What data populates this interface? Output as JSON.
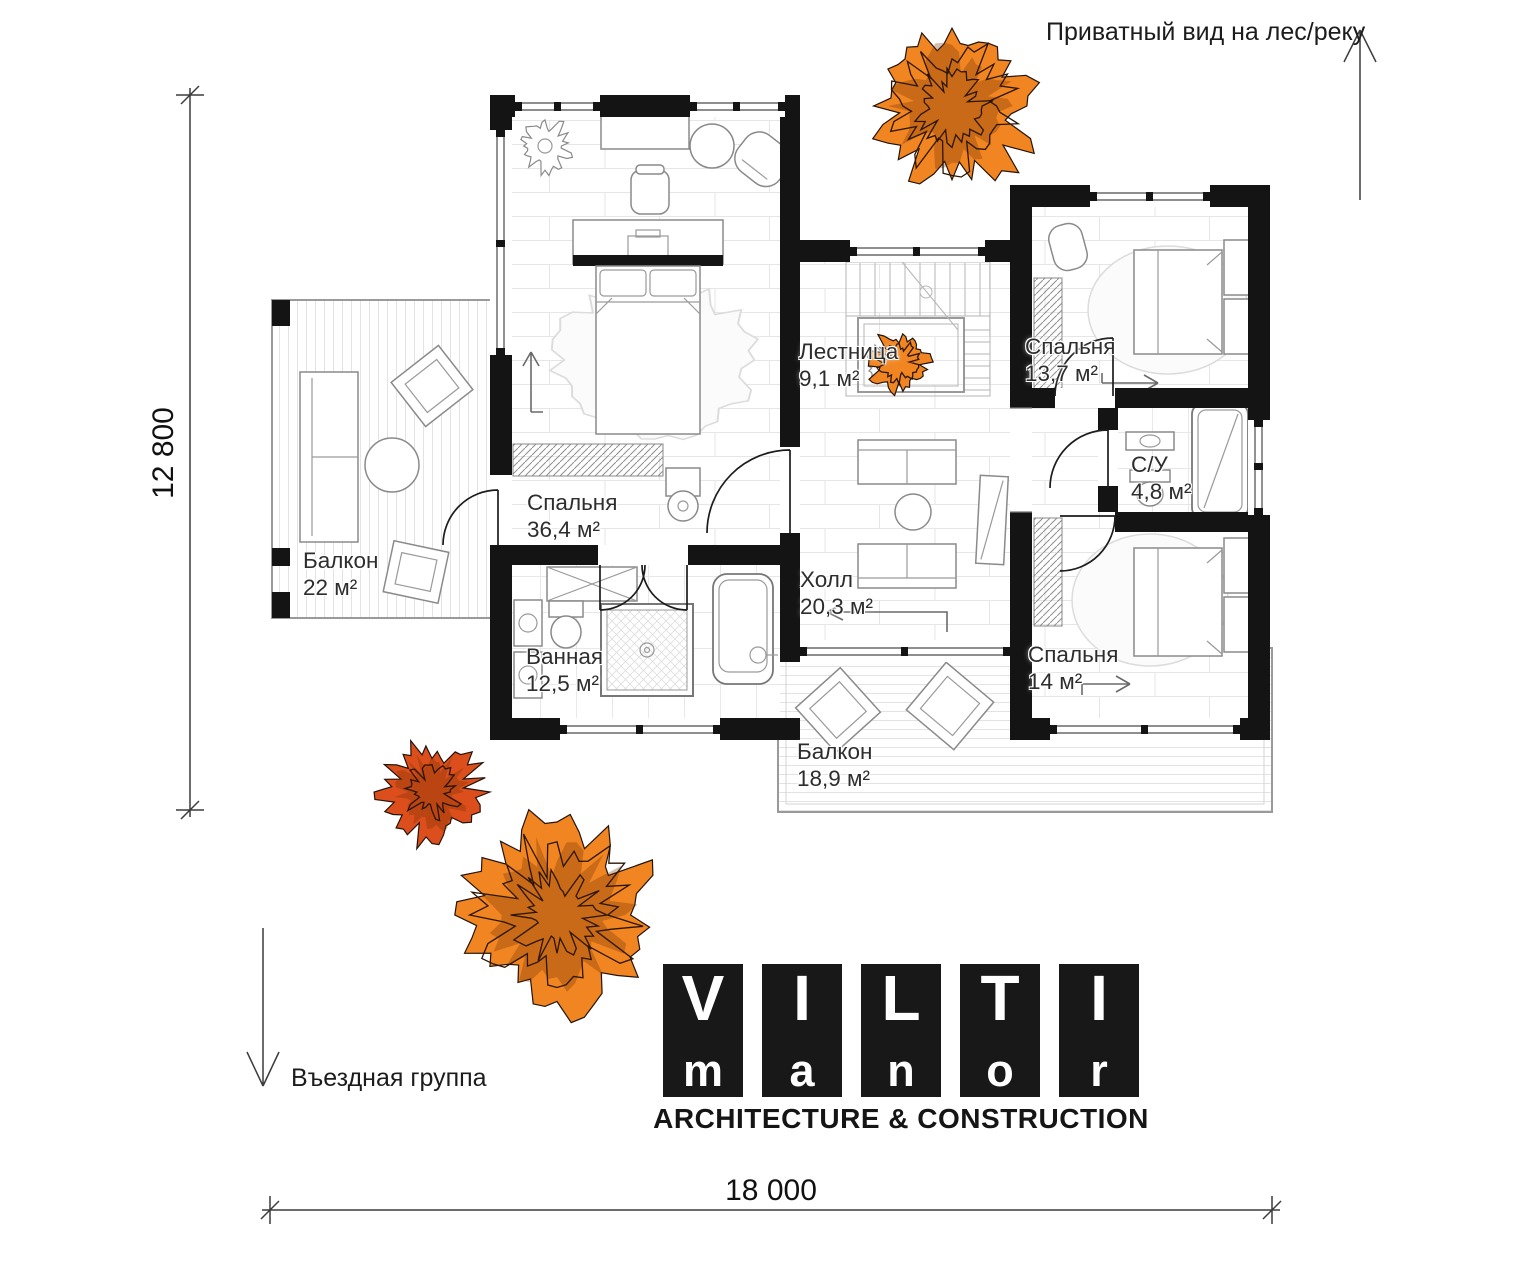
{
  "annotations": {
    "view_note": "Приватный вид на лес/реку",
    "entrance_note": "Въездная группа"
  },
  "dimensions": {
    "width": "18 000",
    "height": "12 800"
  },
  "rooms": [
    {
      "name": "Спальня",
      "area": "36,4 м²"
    },
    {
      "name": "Лестница",
      "area": "9,1 м²"
    },
    {
      "name": "Спальня",
      "area": "13,7 м²"
    },
    {
      "name": "С/У",
      "area": "4,8 м²"
    },
    {
      "name": "Холл",
      "area": "20,3 м²"
    },
    {
      "name": "Спальня",
      "area": "14 м²"
    },
    {
      "name": "Ванная",
      "area": "12,5 м²"
    },
    {
      "name": "Балкон",
      "area": "22 м²"
    },
    {
      "name": "Балкон",
      "area": "18,9 м²"
    }
  ],
  "logo": {
    "tiles": [
      {
        "top": "V",
        "bottom": "m"
      },
      {
        "top": "I",
        "bottom": "a"
      },
      {
        "top": "L",
        "bottom": "n"
      },
      {
        "top": "T",
        "bottom": "o"
      },
      {
        "top": "I",
        "bottom": "r"
      }
    ],
    "tagline": "ARCHITECTURE & CONSTRUCTION"
  },
  "colors": {
    "wall": "#141414",
    "tree_orange": "#F08521",
    "tree_red": "#DC4F1C",
    "logo_black": "#181818"
  }
}
